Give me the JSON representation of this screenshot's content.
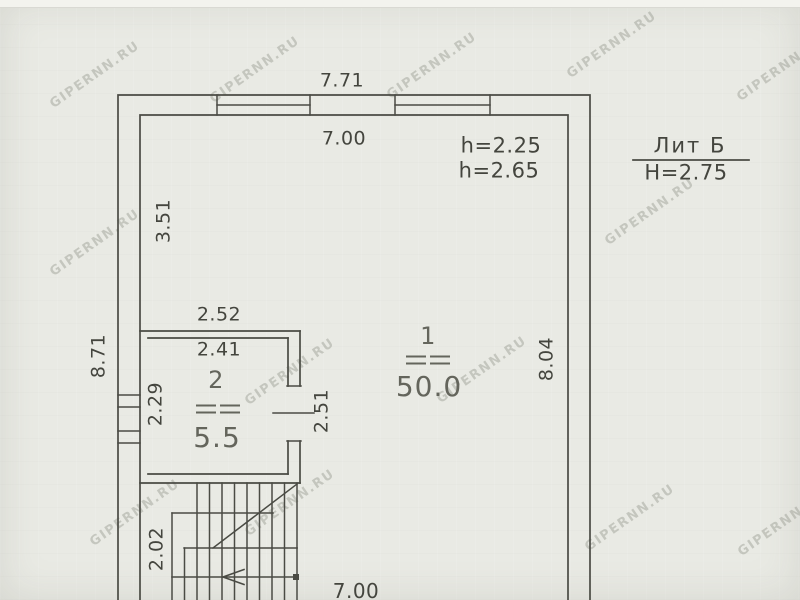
{
  "watermark": {
    "text": "GIPERNN.RU"
  },
  "title_block": {
    "litera": "Лит Б",
    "building_height": "Н=2.75"
  },
  "room_heights": {
    "h1": "h=2.25",
    "h2": "h=2.65"
  },
  "dimensions": {
    "top_outer": "7.71",
    "top_inner": "7.00",
    "left_inner_upper": "3.51",
    "left_outer": "8.71",
    "right_inner": "8.04",
    "bottom_inner": "7.00",
    "room2_width_outer": "2.52",
    "room2_width_inner": "2.41",
    "room2_height_left": "2.29",
    "room2_door_side": "2.51",
    "stair_width": "2.02"
  },
  "rooms": {
    "room1": {
      "number": "1",
      "area": "50.0"
    },
    "room2": {
      "number": "2",
      "area": "5.5"
    }
  }
}
